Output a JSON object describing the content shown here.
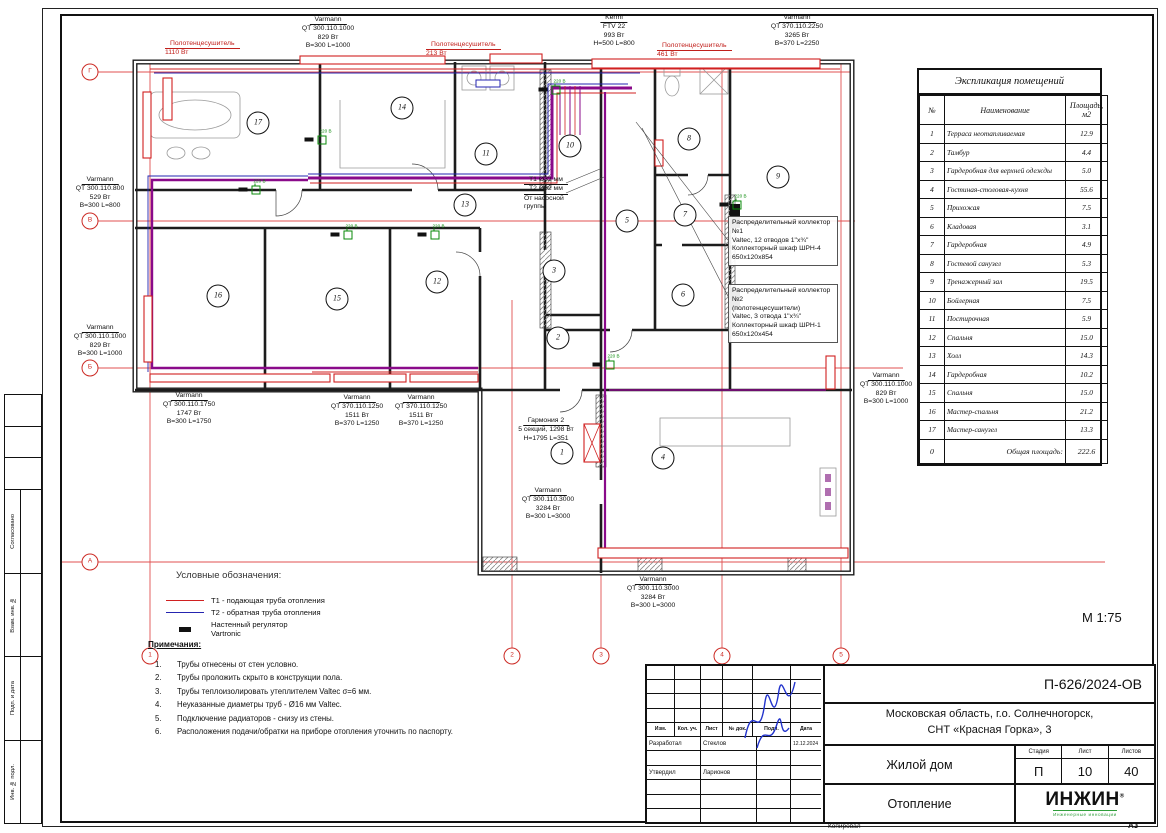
{
  "sheet": {
    "scale_label": "М 1:75",
    "copy_label": "Копировал",
    "format_label": "А3"
  },
  "side_column": {
    "labels": [
      "Согласовано",
      "Взам. инв. №",
      "Подп. и дата",
      "Инв. № подл."
    ]
  },
  "explication": {
    "title": "Экспликация помещений",
    "headers": [
      "№",
      "Наименование",
      "Площадь, м2"
    ],
    "rows": [
      [
        "1",
        "Терраса неотапливаемая",
        "12.9"
      ],
      [
        "2",
        "Тамбур",
        "4.4"
      ],
      [
        "3",
        "Гардеробная для верхней одежды",
        "5.0"
      ],
      [
        "4",
        "Гостиная-столовая-кухня",
        "55.6"
      ],
      [
        "5",
        "Прихожая",
        "7.5"
      ],
      [
        "6",
        "Кладовая",
        "3.1"
      ],
      [
        "7",
        "Гардеробная",
        "4.9"
      ],
      [
        "8",
        "Гостевой санузел",
        "5.3"
      ],
      [
        "9",
        "Тренажерный зал",
        "19.5"
      ],
      [
        "10",
        "Бойлерная",
        "7.5"
      ],
      [
        "11",
        "Постирочная",
        "5.9"
      ],
      [
        "12",
        "Спальня",
        "15.0"
      ],
      [
        "13",
        "Холл",
        "14.3"
      ],
      [
        "14",
        "Гардеробная",
        "10.2"
      ],
      [
        "15",
        "Спальня",
        "15.0"
      ],
      [
        "16",
        "Мастер-спальня",
        "21.2"
      ],
      [
        "17",
        "Мастер-санузел",
        "13.3"
      ]
    ],
    "total_num": "0",
    "total_label": "Общая площадь:",
    "total_value": "222.6"
  },
  "title_block": {
    "code": "П-626/2024-ОВ",
    "address_line1": "Московская область, г.о. Солнечногорск,",
    "address_line2": "СНТ «Красная Горка», 3",
    "object_name": "Жилой дом",
    "sheet_name": "Отопление",
    "stage_label": "Стадия",
    "sheet_label": "Лист",
    "sheets_label": "Листов",
    "stage": "П",
    "sheet": "10",
    "sheets": "40",
    "header_cols": [
      "Изм.",
      "Кол. уч.",
      "Лист",
      "№ док.",
      "Подп.",
      "Дата"
    ],
    "developed_label": "Разработал",
    "developed_name": "Стеклов",
    "approved_label": "Утвердил",
    "approved_name": "Ларионов",
    "date": "12.12.2024",
    "logo_main": "ИНЖИН",
    "logo_reg": "®",
    "logo_sub": "Инженерные инновации"
  },
  "legend": {
    "title": "Условные обозначения:",
    "items": [
      {
        "swatch": "t1",
        "lines": [
          "Т1 - подающая труба отопления"
        ]
      },
      {
        "swatch": "t2",
        "lines": [
          "Т2 - обратная труба отопления"
        ]
      },
      {
        "swatch": "rg",
        "lines": [
          "Настенный регулятор",
          "Vartronic"
        ]
      }
    ]
  },
  "notes": {
    "title": "Примечания:",
    "items": [
      "Трубы отнесены от стен условно.",
      "Трубы проложить скрыто в конструкции пола.",
      "Трубы теплоизолировать утеплителем Valtec σ=6 мм.",
      "Неуказанные диаметры труб - Ø16 мм Valtec.",
      "Подключение радиаторов - снизу из стены.",
      "Расположения подачи/обратки на приборе отопления уточнить по паспорту."
    ]
  },
  "plan": {
    "regulator_label": "220 В",
    "regulators": [
      {
        "x": 322,
        "y": 140
      },
      {
        "x": 256,
        "y": 190
      },
      {
        "x": 348,
        "y": 235
      },
      {
        "x": 435,
        "y": 235
      },
      {
        "x": 556,
        "y": 90
      },
      {
        "x": 737,
        "y": 205
      },
      {
        "x": 610,
        "y": 365
      }
    ],
    "rooms": [
      {
        "n": "17",
        "x": 258,
        "y": 123
      },
      {
        "n": "14",
        "x": 402,
        "y": 108
      },
      {
        "n": "11",
        "x": 486,
        "y": 154
      },
      {
        "n": "13",
        "x": 465,
        "y": 205
      },
      {
        "n": "10",
        "x": 570,
        "y": 146
      },
      {
        "n": "8",
        "x": 689,
        "y": 139
      },
      {
        "n": "9",
        "x": 778,
        "y": 177
      },
      {
        "n": "5",
        "x": 627,
        "y": 221
      },
      {
        "n": "7",
        "x": 685,
        "y": 215
      },
      {
        "n": "3",
        "x": 554,
        "y": 271
      },
      {
        "n": "6",
        "x": 683,
        "y": 295
      },
      {
        "n": "2",
        "x": 558,
        "y": 338
      },
      {
        "n": "16",
        "x": 218,
        "y": 296
      },
      {
        "n": "15",
        "x": 337,
        "y": 299
      },
      {
        "n": "12",
        "x": 437,
        "y": 282
      },
      {
        "n": "1",
        "x": 562,
        "y": 453
      },
      {
        "n": "4",
        "x": 663,
        "y": 458
      }
    ],
    "axes": {
      "h": [
        {
          "label": "Г",
          "y": 72
        },
        {
          "label": "В",
          "y": 221
        },
        {
          "label": "Б",
          "y": 368
        },
        {
          "label": "А",
          "y": 562
        }
      ],
      "v": [
        {
          "label": "1",
          "x": 150
        },
        {
          "label": "2",
          "x": 512
        },
        {
          "label": "3",
          "x": 601
        },
        {
          "label": "4",
          "x": 722
        },
        {
          "label": "5",
          "x": 841
        }
      ]
    },
    "labels": [
      {
        "x": 328,
        "y": 16,
        "align": "center",
        "u": 1,
        "lines": [
          "Varmann",
          "QT 300.110.1000",
          "829 Вт",
          "B=300 L=1000"
        ]
      },
      {
        "x": 165,
        "y": 40,
        "align": "left",
        "u": 1,
        "color": "red",
        "lines": [
          "Полотенцесушитель",
          "1110 Вт"
        ]
      },
      {
        "x": 426,
        "y": 41,
        "align": "left",
        "u": 1,
        "color": "red",
        "lines": [
          "Полотенцесушитель",
          "213 Вт"
        ]
      },
      {
        "x": 614,
        "y": 14,
        "align": "center",
        "u": 1,
        "lines": [
          "Kermi",
          "FTV 22",
          "993 Вт",
          "H=500 L=800"
        ]
      },
      {
        "x": 657,
        "y": 42,
        "align": "left",
        "u": 1,
        "color": "red",
        "lines": [
          "Полотенцесушитель",
          "461 Вт"
        ]
      },
      {
        "x": 797,
        "y": 14,
        "align": "center",
        "u": 1,
        "lines": [
          "Varmann",
          "QT 370.110.2250",
          "3265 Вт",
          "B=370 L=2250"
        ]
      },
      {
        "x": 100,
        "y": 176,
        "align": "center",
        "u": 1,
        "lines": [
          "Varmann",
          "QT 300.110.800",
          "529 Вт",
          "B=300 L=800"
        ]
      },
      {
        "x": 100,
        "y": 324,
        "align": "center",
        "u": 1,
        "lines": [
          "Varmann",
          "QT 300.110.1000",
          "829 Вт",
          "B=300 L=1000"
        ]
      },
      {
        "x": 189,
        "y": 392,
        "align": "center",
        "u": 1,
        "lines": [
          "Varmann",
          "QT 300.110.1750",
          "1747 Вт",
          "B=300 L=1750"
        ]
      },
      {
        "x": 357,
        "y": 394,
        "align": "center",
        "u": 1,
        "lines": [
          "Varmann",
          "QT 370.110.1250",
          "1511 Вт",
          "B=370 L=1250"
        ]
      },
      {
        "x": 421,
        "y": 394,
        "align": "center",
        "u": 1,
        "lines": [
          "Varmann",
          "QT 370.110.1250",
          "1511 Вт",
          "B=370 L=1250"
        ]
      },
      {
        "x": 546,
        "y": 417,
        "align": "center",
        "u": 1,
        "lines": [
          "Гармония 2",
          "5 секций, 1298 Вт",
          "H=1795 L=351"
        ]
      },
      {
        "x": 548,
        "y": 487,
        "align": "center",
        "u": 1,
        "lines": [
          "Varmann",
          "QT 300.110.3000",
          "3284 Вт",
          "B=300 L=3000"
        ]
      },
      {
        "x": 653,
        "y": 576,
        "align": "center",
        "u": 1,
        "lines": [
          "Varmann",
          "QT 300.110.3000",
          "3284 Вт",
          "B=300 L=3000"
        ]
      },
      {
        "x": 886,
        "y": 372,
        "align": "center",
        "u": 1,
        "lines": [
          "Varmann",
          "QT 300.110.1000",
          "829 Вт",
          "B=300 L=1000"
        ]
      },
      {
        "x": 524,
        "y": 176,
        "align": "left",
        "u": 2,
        "lines": [
          "Т1 Ø32 мм",
          "Т2 Ø32 мм",
          "От насосной",
          "группы"
        ]
      },
      {
        "x": 728,
        "y": 216,
        "align": "left",
        "box": true,
        "lines": [
          "Распределительный коллектор №1",
          "Valtec, 12 отводов 1\"х¾\"",
          "Коллекторный шкаф ШРН-4",
          "650х120х854"
        ]
      },
      {
        "x": 728,
        "y": 284,
        "align": "left",
        "box": true,
        "lines": [
          "Распределительный коллектор №2",
          "(полотенцесушители)",
          "Valtec, 3 отвода 1\"х¾\"",
          "Коллекторный шкаф ШРН-1",
          "650х120х454"
        ]
      }
    ]
  }
}
